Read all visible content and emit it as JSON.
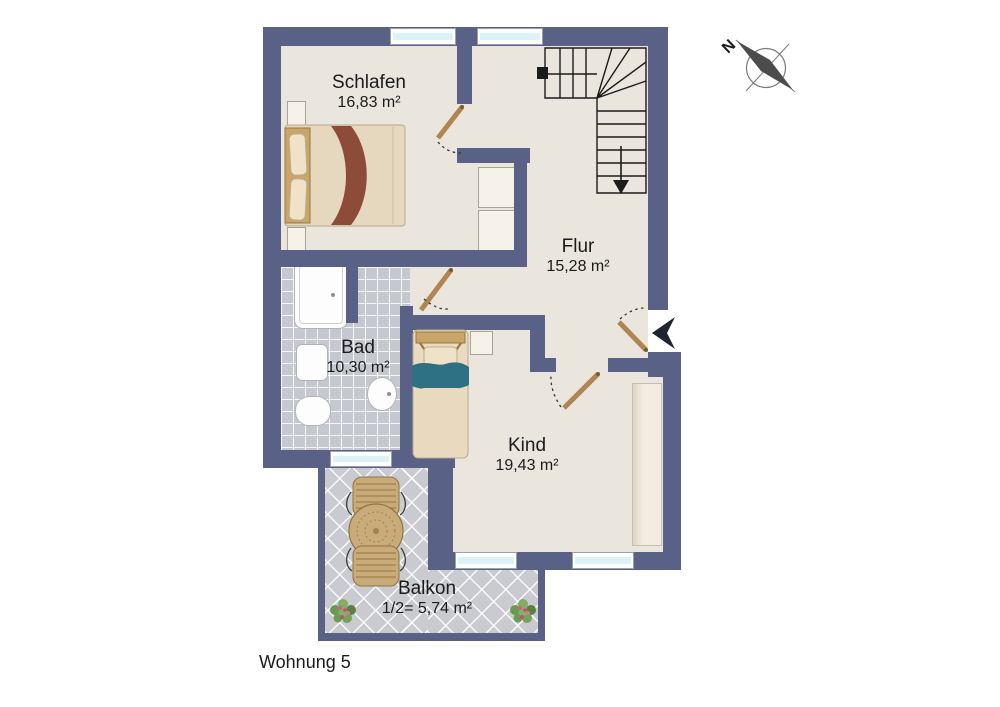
{
  "title": "Wohnung 5",
  "compass": {
    "label": "N"
  },
  "rooms": [
    {
      "id": "schlafen",
      "name": "Schlafen",
      "area": "16,83 m²"
    },
    {
      "id": "flur",
      "name": "Flur",
      "area": "15,28 m²"
    },
    {
      "id": "bad",
      "name": "Bad",
      "area": "10,30 m²"
    },
    {
      "id": "kind",
      "name": "Kind",
      "area": "19,43 m²"
    },
    {
      "id": "balkon",
      "name": "Balkon",
      "area": "1/2= 5,74 m²"
    }
  ],
  "colors": {
    "wall": "#5a6186",
    "floor": "#eae6de",
    "bath_tile": "#c5c8ce",
    "balcony_tile": "#c9cbd0",
    "window_glass": "#dcf2f9",
    "wood": "#c9ab79",
    "bed_linen": "#e6d8be",
    "bed_accent_red": "#8d4b3a",
    "kind_bed_teal": "#2e7084"
  }
}
